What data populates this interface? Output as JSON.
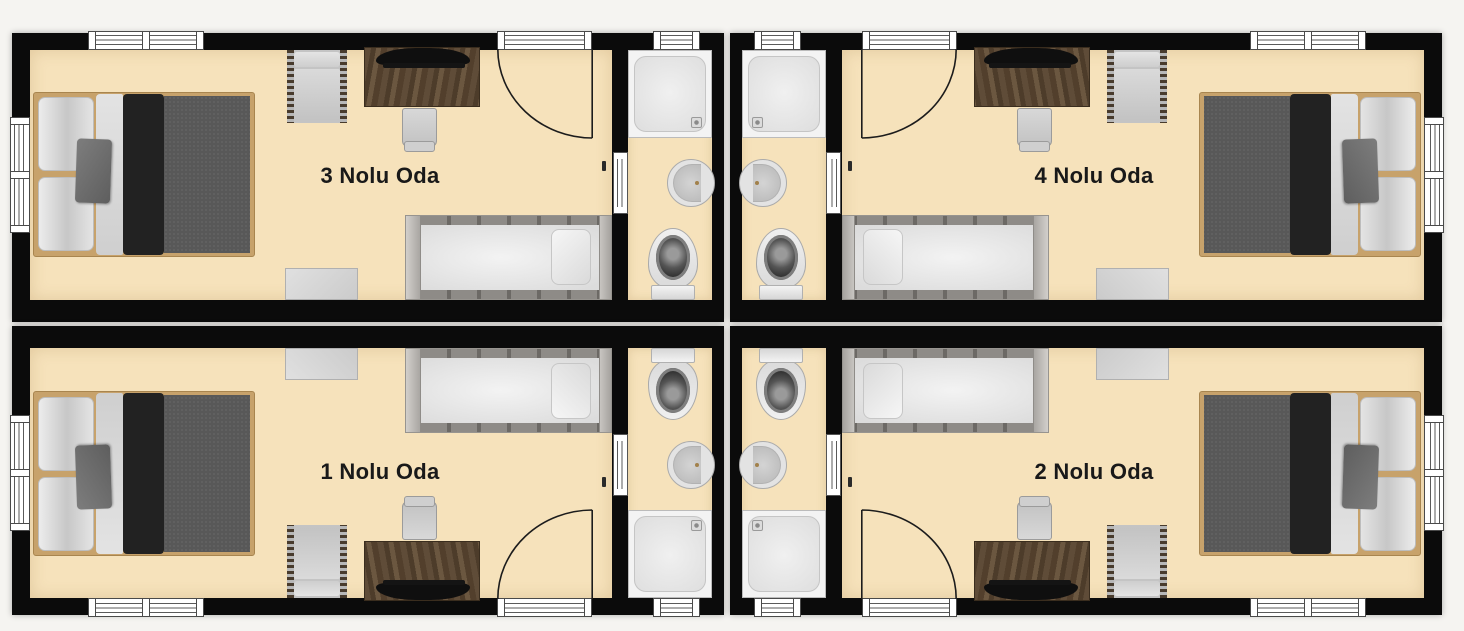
{
  "rooms": [
    {
      "id": "room-3",
      "label": "3 Nolu Oda",
      "position": "top-left"
    },
    {
      "id": "room-4",
      "label": "4 Nolu Oda",
      "position": "top-right"
    },
    {
      "id": "room-1",
      "label": "1 Nolu Oda",
      "position": "bottom-left"
    },
    {
      "id": "room-2",
      "label": "2 Nolu Oda",
      "position": "bottom-right"
    }
  ],
  "room_fixtures": [
    "double-bed",
    "single-bed",
    "desk",
    "monitor",
    "desk-chair",
    "armchair",
    "side-table",
    "entrance-door",
    "windows"
  ],
  "bathroom_fixtures": [
    "shower",
    "washbasin",
    "toilet",
    "bathroom-door",
    "window"
  ],
  "palette": {
    "bg": "#f5f4f1",
    "wall": "#0b0b0b",
    "floor": "#f6e2bb",
    "bedframe": "#c7a26b",
    "duvet": "#585858",
    "bedblack": "#222222",
    "label": "#191919"
  }
}
